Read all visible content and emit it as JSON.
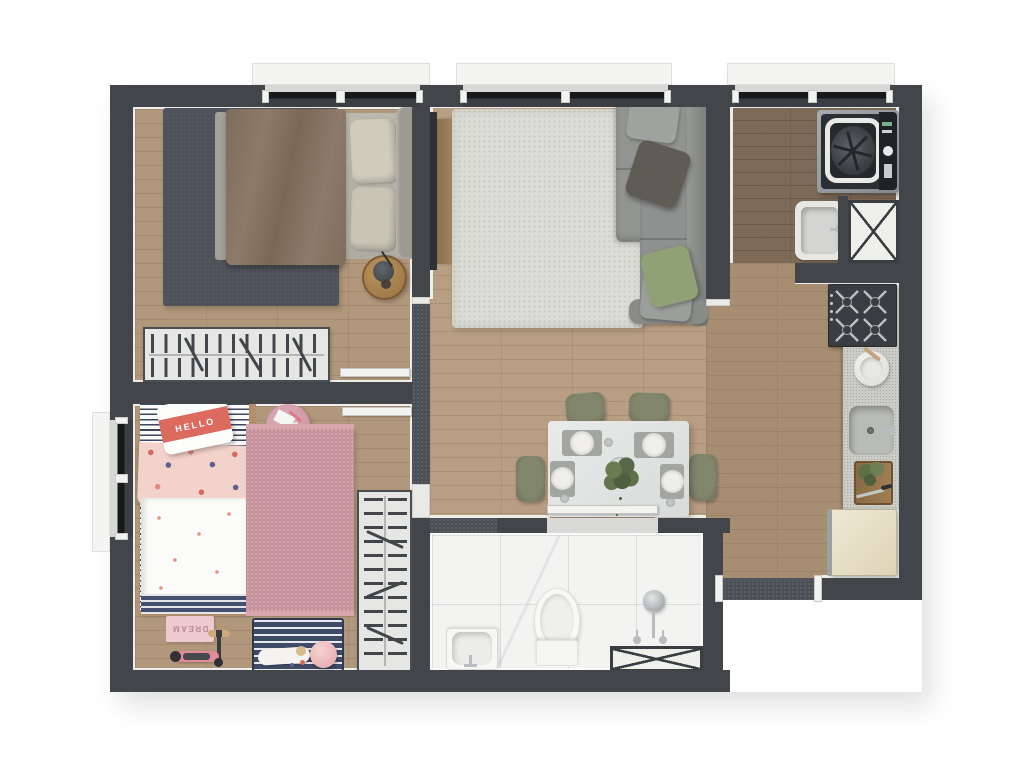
{
  "scene": {
    "name": "apartment-floor-plan-top-view",
    "style": "3d-rendered-floor-plan",
    "background": "#ffffff"
  },
  "texts": {
    "kids_pillow": "HELLO",
    "kids_mat": "DREAM"
  },
  "palette": {
    "wall": "#42464b",
    "wall_speckle": "#4c5056",
    "wood_floor": "#b1977b",
    "wood_floor_light": "#b89e82",
    "wood_floor_dark": "#7e6b57",
    "marble_floor": "#f3f3f2",
    "door_white": "#f2f2f1",
    "master_rug": "#4e525a",
    "living_rug": "#dcdcd7",
    "kids_rug": "#c6929c",
    "sofa_grey": "#8f9190",
    "pillow_green": "#91a176",
    "duvet_brown": "#86735f",
    "dining_chair_green": "#767a62",
    "fridge_cream": "#e7dfc6",
    "kids_pink": "#e08b97"
  },
  "rooms": [
    {
      "id": "master-bedroom",
      "furniture": [
        "double-bed",
        "brown-duvet",
        "pillows",
        "dark-area-rug",
        "round-side-table",
        "wardrobe-rail",
        "window"
      ]
    },
    {
      "id": "living-room",
      "furniture": [
        "corner-sofa",
        "throw-pillows",
        "shag-rug",
        "tv-panel",
        "tv-console",
        "window"
      ]
    },
    {
      "id": "dining-area",
      "furniture": [
        "dining-table",
        "four-chairs",
        "four-place-settings",
        "centerpiece-plant"
      ]
    },
    {
      "id": "kitchen",
      "furniture": [
        "gas-cooktop",
        "stone-counter",
        "mortar-bowl",
        "kitchen-sink",
        "cutting-board",
        "refrigerator"
      ]
    },
    {
      "id": "laundry-area",
      "furniture": [
        "top-load-washer",
        "laundry-tub",
        "service-shaft",
        "window"
      ]
    },
    {
      "id": "kids-bedroom",
      "furniture": [
        "single-bed",
        "hello-pillow",
        "patterned-blanket",
        "pink-rug",
        "pink-pouf",
        "wardrobe-rail",
        "dream-mat",
        "scooter",
        "striped-play-mat",
        "plush-toy",
        "pink-ball",
        "window"
      ]
    },
    {
      "id": "bathroom",
      "furniture": [
        "washbasin",
        "toilet",
        "shower-head",
        "service-shaft",
        "marble-floor"
      ]
    }
  ],
  "openings": {
    "windows": [
      "master-bedroom-window",
      "living-room-window",
      "laundry-window",
      "kids-bedroom-window"
    ],
    "doors": [
      "master-bedroom-door",
      "kids-bedroom-door",
      "bathroom-door",
      "entry-door"
    ]
  }
}
